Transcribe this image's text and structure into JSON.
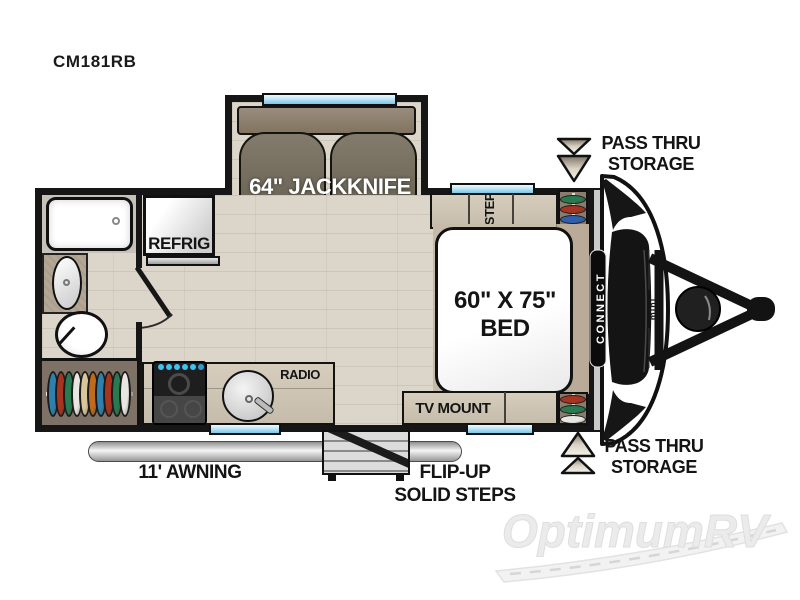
{
  "title": "CM181RB",
  "slide": {
    "label": "64\" JACKKNIFE"
  },
  "kitchen": {
    "refrig": "REFRIG",
    "radio": "RADIO"
  },
  "bedroom": {
    "step": "STEP",
    "bed_line1": "60\" X 75\"",
    "bed_line2": "BED",
    "tv_mount": "TV MOUNT"
  },
  "storage_top": {
    "line1": "PASS THRU",
    "line2": "STORAGE"
  },
  "storage_bottom": {
    "line1": "PASS THRU",
    "line2": "STORAGE"
  },
  "exterior": {
    "awning": "11' AWNING",
    "steps_line1": "FLIP-UP",
    "steps_line2": "SOLID STEPS"
  },
  "front_cap": {
    "brand": "CONNECT",
    "sub_brand": "mini"
  },
  "watermark": "OptimumRV",
  "closets": {
    "left": {
      "colors": [
        "#2f81ad",
        "#a63420",
        "#2a7a50",
        "#e8e6e0",
        "#d9c79b",
        "#c06a1e",
        "#2f81ad",
        "#a63420",
        "#2a7a50",
        "#e8e6e0"
      ]
    },
    "top_right": {
      "colors": [
        "#2a7a50",
        "#a63420",
        "#2f5fad"
      ]
    },
    "bottom_right": {
      "colors": [
        "#a63420",
        "#2a7a50",
        "#e8e6e0"
      ]
    }
  },
  "colors": {
    "wall": "#161616",
    "floor": "#dcd6ca",
    "counter": "#ccc3b3",
    "window_blue": "#9ed4ee",
    "sofa": "#6f685b",
    "watermark_gray": "#ebebeb"
  }
}
